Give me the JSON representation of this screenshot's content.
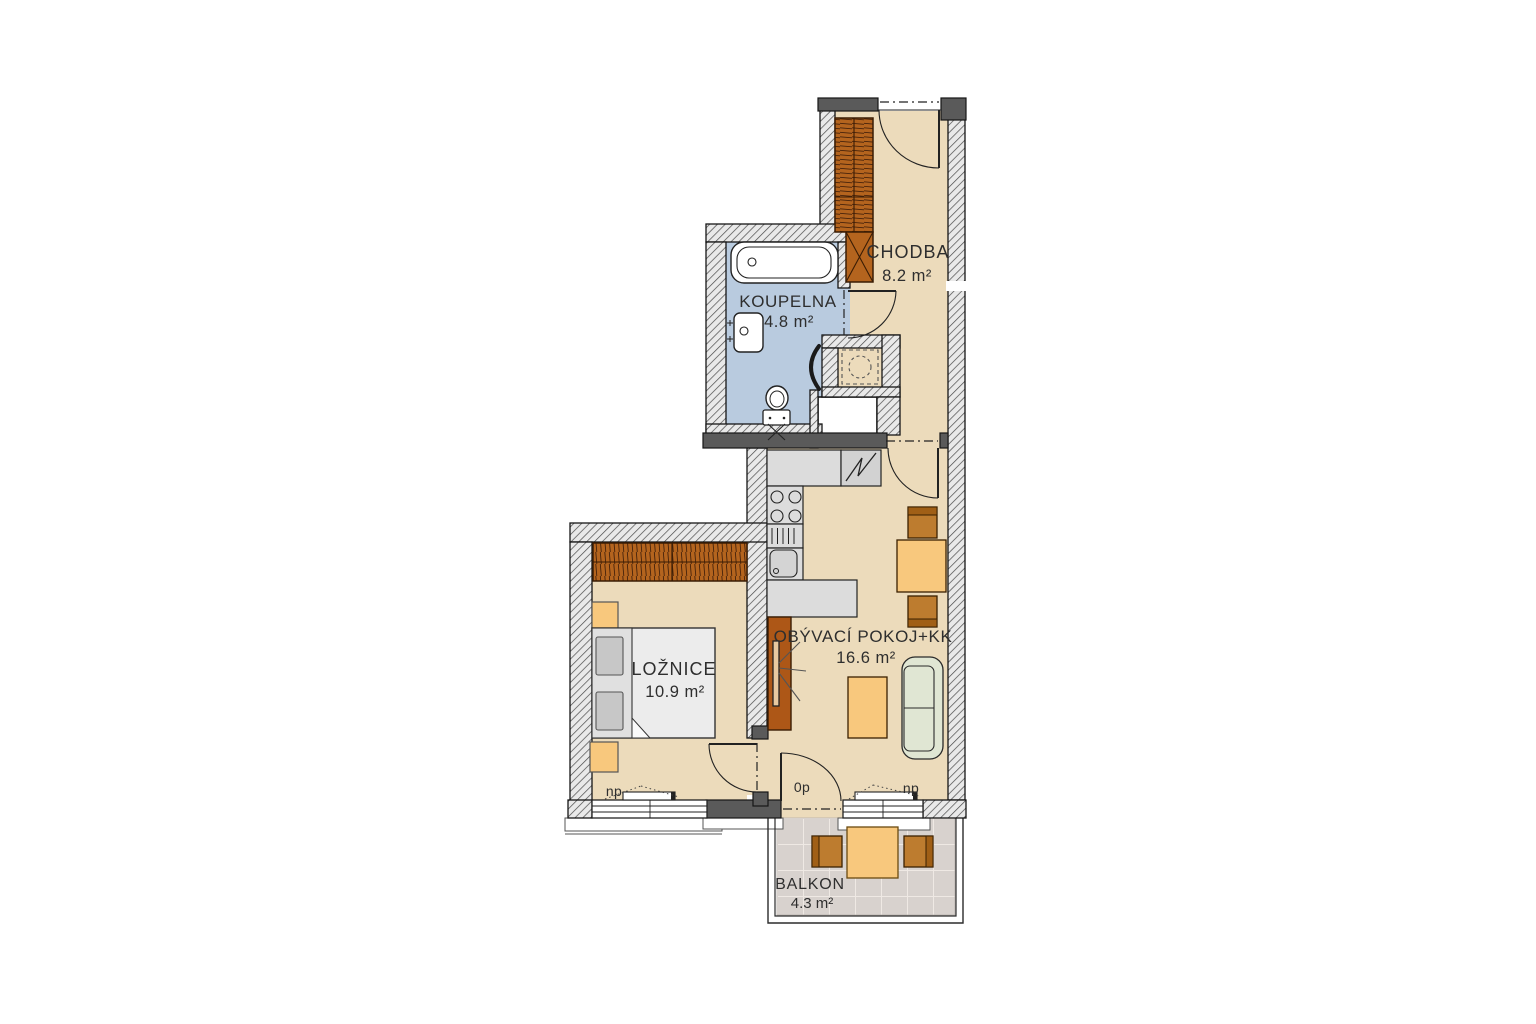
{
  "rooms": {
    "chodba": {
      "name": "CHODBA",
      "area": "8.2 m²"
    },
    "koupelna": {
      "name": "KOUPELNA",
      "area": "4.8 m²"
    },
    "loznice": {
      "name": "LOŽNICE",
      "area": "10.9 m²"
    },
    "obyvaci": {
      "name": "OBÝVACÍ POKOJ+KK",
      "area": "16.6 m²"
    },
    "balkon": {
      "name": "BALKON",
      "area": "4.3 m²"
    }
  },
  "markers": {
    "bedroom_radiator": "np",
    "living_radiator": "np",
    "balcony_threshold": "0p"
  },
  "colors": {
    "floor": "#ecdbbb",
    "bathroom_floor": "#b9cbdf",
    "wall_solid": "#5a5a5a",
    "wall_hatch_bg": "#e9e9e9",
    "furniture_wood": "#b4641e",
    "furniture_wood_dark": "#a05f16",
    "chair_wood": "#bd7c2f",
    "accent_light_wood": "#f8c87d",
    "sofa": "#e0e6d3",
    "counter_gray": "#dcdcdc",
    "balcony_tile": "#d8d2ce"
  }
}
